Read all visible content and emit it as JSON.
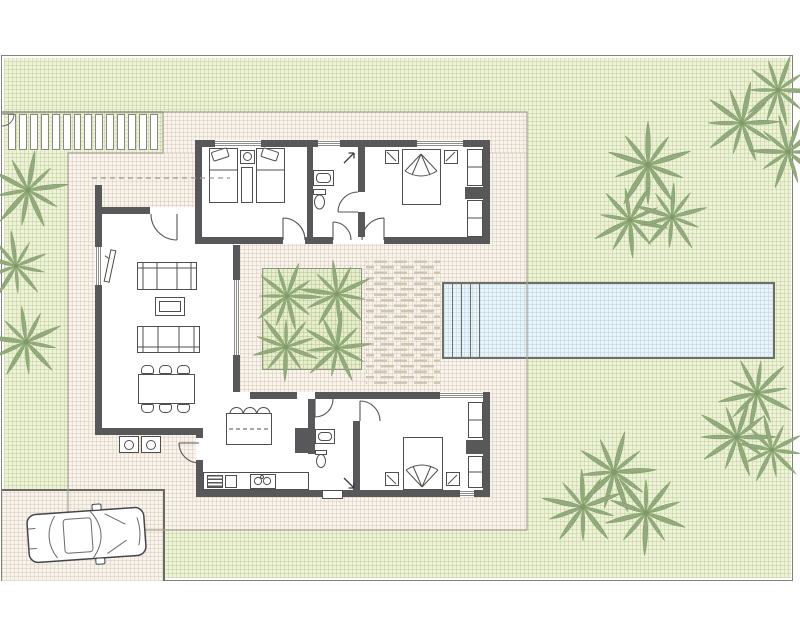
{
  "scene": {
    "description": "Top-view architectural site plan of a single-storey villa with garden, swimming pool, pergola, driveway with car, and interior courtyard",
    "width": 800,
    "height": 640
  },
  "colors": {
    "background": "#ffffff",
    "boundary_line": "#82827b",
    "garden_fill": "#edf2d9",
    "garden_grid": "#cdd9ab",
    "terrace_fill": "#f8f4ed",
    "terrace_grid": "#e2d9c9",
    "wall": "#58585a",
    "furniture_outline": "#4f4f4d",
    "pool_water": "#e9f3f8",
    "pool_border": "#6f6f68",
    "palm_green": "#93ab7c",
    "palm_dark": "#7f9a66",
    "planter_fill": "#e6eecd",
    "deck_dash": "#cdc5b2"
  },
  "site": {
    "boundary": {
      "x": 1,
      "y": 55,
      "w": 792,
      "h": 526
    }
  },
  "garden": {
    "pergola": {
      "x": 8,
      "y": 114,
      "w": 150,
      "h": 36,
      "slat_count": 14
    },
    "pool": {
      "x": 442,
      "y": 282,
      "w": 333,
      "h": 77,
      "step_count": 4
    },
    "driveway": {
      "x": 2,
      "y": 489,
      "w": 163,
      "h": 92
    },
    "car": {
      "x": 86,
      "y": 535,
      "rotation": -4
    },
    "palms": [
      {
        "x": 28,
        "y": 190,
        "s": 1.05,
        "r": 10
      },
      {
        "x": 16,
        "y": 266,
        "s": 0.9,
        "r": 140
      },
      {
        "x": 26,
        "y": 342,
        "s": 1.0,
        "r": 65
      },
      {
        "x": 648,
        "y": 165,
        "s": 1.15,
        "r": 0
      },
      {
        "x": 630,
        "y": 220,
        "s": 1.0,
        "r": 30
      },
      {
        "x": 672,
        "y": 217,
        "s": 0.95,
        "r": 75
      },
      {
        "x": 742,
        "y": 123,
        "s": 1.05,
        "r": 160
      },
      {
        "x": 778,
        "y": 90,
        "s": 0.95,
        "r": 20
      },
      {
        "x": 788,
        "y": 152,
        "s": 1.0,
        "r": 200
      },
      {
        "x": 757,
        "y": 393,
        "s": 1.0,
        "r": 45
      },
      {
        "x": 737,
        "y": 437,
        "s": 1.05,
        "r": 90
      },
      {
        "x": 772,
        "y": 450,
        "s": 0.9,
        "r": 135
      },
      {
        "x": 614,
        "y": 472,
        "s": 1.1,
        "r": 15
      },
      {
        "x": 583,
        "y": 507,
        "s": 1.05,
        "r": 70
      },
      {
        "x": 646,
        "y": 513,
        "s": 1.1,
        "r": 110
      }
    ]
  },
  "courtyard": {
    "planter": {
      "x": 262,
      "y": 268,
      "w": 100,
      "h": 102
    },
    "deck": {
      "x": 366,
      "y": 258,
      "w": 74,
      "h": 127
    },
    "palms": [
      {
        "x": 287,
        "y": 296,
        "s": 0.92,
        "r": 20
      },
      {
        "x": 337,
        "y": 294,
        "s": 0.95,
        "r": 65
      },
      {
        "x": 286,
        "y": 347,
        "s": 0.9,
        "r": 110
      },
      {
        "x": 337,
        "y": 348,
        "s": 0.95,
        "r": 155
      }
    ]
  },
  "house": {
    "rooms": [
      {
        "name": "bedroom-1",
        "furniture": [
          "twin-bed",
          "twin-bed",
          "nightstand",
          "bedside-rug"
        ]
      },
      {
        "name": "bathroom-1",
        "furniture": [
          "washbasin",
          "toilet"
        ]
      },
      {
        "name": "bedroom-2",
        "furniture": [
          "double-bed",
          "nightstand",
          "nightstand",
          "wardrobe"
        ]
      },
      {
        "name": "living-room",
        "furniture": [
          "sofa",
          "sofa",
          "coffee-table",
          "tv"
        ]
      },
      {
        "name": "dining-area",
        "furniture": [
          "dining-table"
        ],
        "chair_count": 6
      },
      {
        "name": "kitchen",
        "furniture": [
          "island",
          "oven",
          "counter-unit",
          "hob"
        ],
        "stool_count": 3
      },
      {
        "name": "bathroom-2",
        "furniture": [
          "washbasin",
          "toilet"
        ]
      },
      {
        "name": "bedroom-3",
        "furniture": [
          "double-bed",
          "nightstand",
          "nightstand",
          "wardrobe"
        ]
      },
      {
        "name": "outdoor-bbq-terrace",
        "bbq_unit_count": 2
      }
    ],
    "entry_arrows": 2
  }
}
